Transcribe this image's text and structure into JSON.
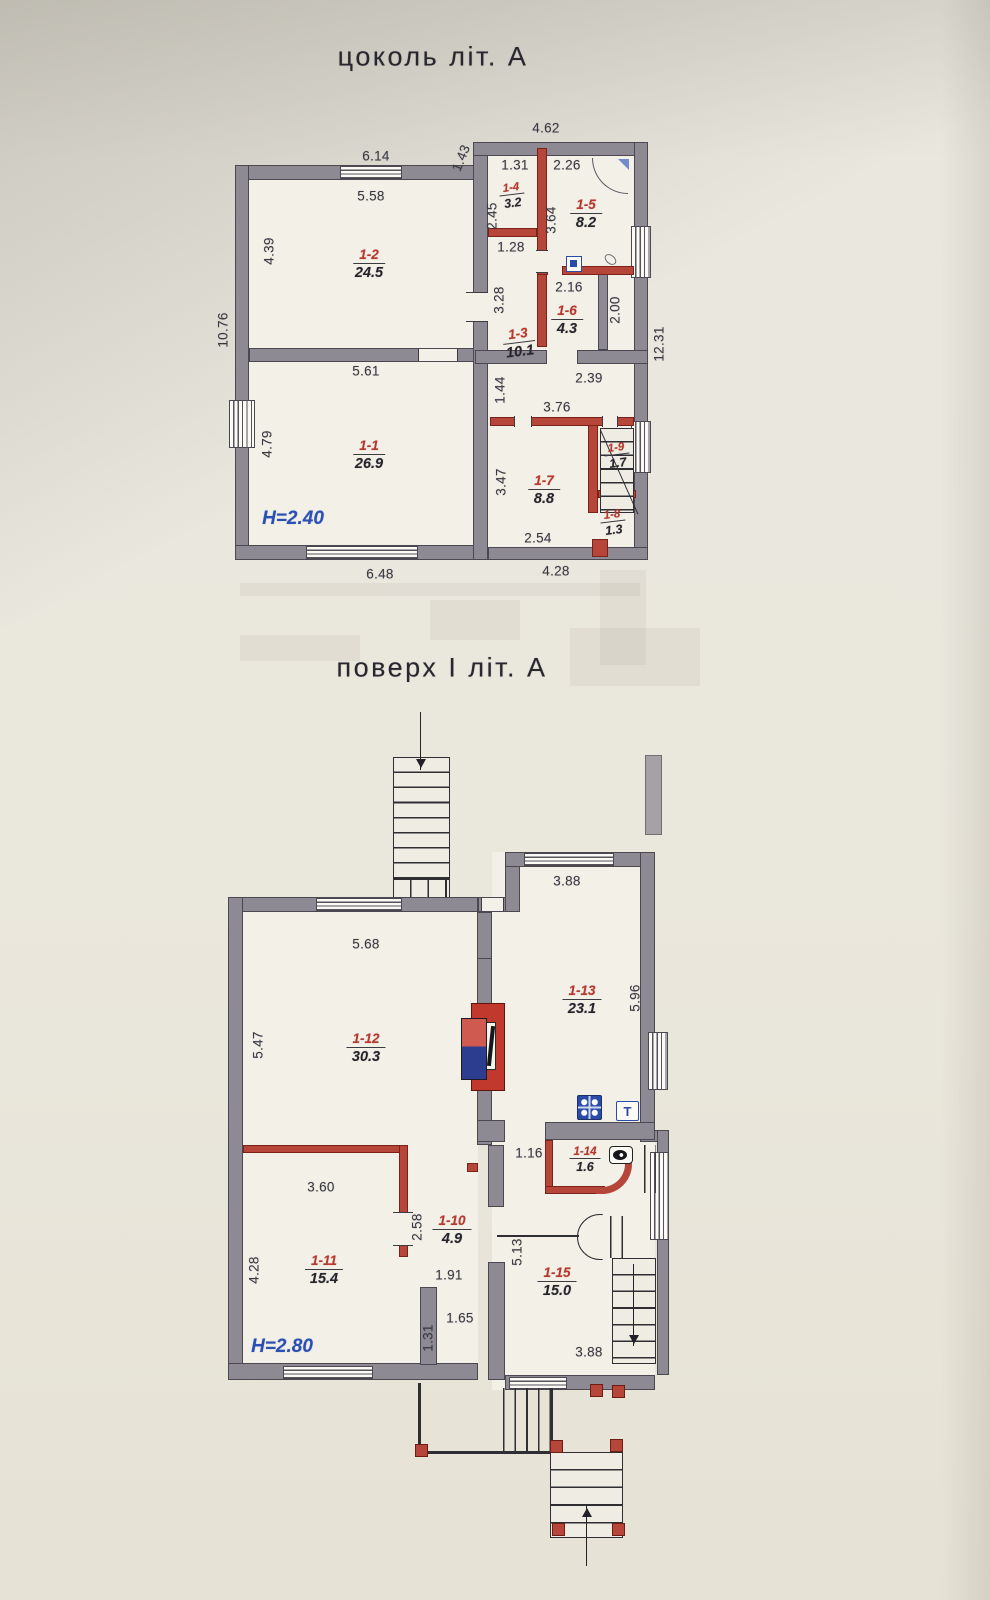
{
  "basement": {
    "title": "цоколь літ. А",
    "height": "H=2.40",
    "dims": {
      "top_win_out": "6.14",
      "top_win_in": "5.58",
      "step": "1.43",
      "top_right": "4.62",
      "r4_w": "1.31",
      "r5_w": "2.26",
      "r4_h": "2.45",
      "r5_h": "3.64",
      "r4_door": "1.28",
      "corr_h": "3.28",
      "r6_w": "2.16",
      "r6_h": "2.00",
      "left_out": "10.76",
      "r2_h": "4.39",
      "mid_w": "5.61",
      "hall_step": "1.44",
      "hall_top": "2.39",
      "hall_w": "3.76",
      "r1_h": "4.79",
      "r7_h": "3.47",
      "r7_w": "2.54",
      "bot_left": "6.48",
      "bot_right": "4.28",
      "right_out": "12.31"
    },
    "rooms": {
      "r1": {
        "id": "1-1",
        "area": "26.9"
      },
      "r2": {
        "id": "1-2",
        "area": "24.5"
      },
      "r3": {
        "id": "1-3",
        "area": "10.1"
      },
      "r4": {
        "id": "1-4",
        "area": "3.2"
      },
      "r5": {
        "id": "1-5",
        "area": "8.2"
      },
      "r6": {
        "id": "1-6",
        "area": "4.3"
      },
      "r7": {
        "id": "1-7",
        "area": "8.8"
      },
      "r8": {
        "id": "1-8",
        "area": "1.3"
      },
      "r9": {
        "id": "1-9",
        "area": "1.7"
      }
    }
  },
  "floor1": {
    "title": "поверх І літ. А",
    "height": "H=2.80",
    "dims": {
      "top_right_win": "3.88",
      "top_left_win": "5.68",
      "r12_h": "5.47",
      "r13_h": "5.96",
      "wc_w": "1.16",
      "r11_top": "3.60",
      "r10_door": "2.58",
      "r11_h": "4.28",
      "hall_w1": "1.91",
      "hall_w2": "1.65",
      "hall_h": "1.31",
      "r15_h": "5.13",
      "r15_bot": "3.88"
    },
    "rooms": {
      "r10": {
        "id": "1-10",
        "area": "4.9"
      },
      "r11": {
        "id": "1-11",
        "area": "15.4"
      },
      "r12": {
        "id": "1-12",
        "area": "30.3"
      },
      "r13": {
        "id": "1-13",
        "area": "23.1"
      },
      "r14": {
        "id": "1-14",
        "area": "1.6"
      },
      "r15": {
        "id": "1-15",
        "area": "15.0"
      }
    },
    "icons": {
      "sink_label": "Т"
    }
  },
  "colors": {
    "wall_gray": "#8e8a93",
    "wall_red": "#b7463a",
    "room_id_red": "#b8372e",
    "height_blue": "#2b50b4",
    "icon_blue": "#2b4ba8"
  }
}
